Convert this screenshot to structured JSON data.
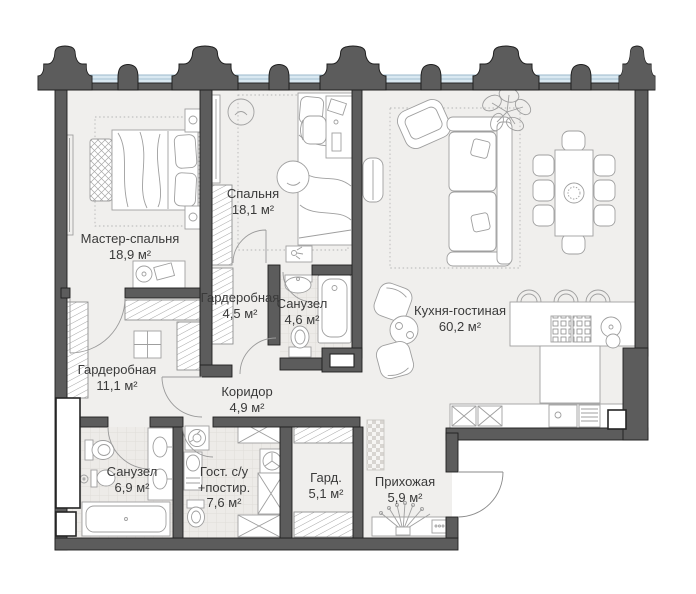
{
  "plan": {
    "type": "apartment-floor-plan",
    "rooms": [
      {
        "name": "Мастер-спальня",
        "area": "18,9 м²"
      },
      {
        "name": "Спальня",
        "area": "18,1 м²"
      },
      {
        "name": "Гардеробная",
        "area": "4,5 м²"
      },
      {
        "name": "Санузел",
        "area": "4,6 м²"
      },
      {
        "name": "Кухня-гостиная",
        "area": "60,2 м²"
      },
      {
        "name": "Гардеробная",
        "area": "11,1 м²"
      },
      {
        "name": "Коридор",
        "area": "4,9 м²"
      },
      {
        "name": "Санузел",
        "area": "6,9 м²"
      },
      {
        "name": "Гост. с/у",
        "name2": "+постир.",
        "area": "7,6 м²"
      },
      {
        "name": "Гард.",
        "area": "5,1 м²"
      },
      {
        "name": "Прихожая",
        "area": "5,9 м²"
      }
    ],
    "colors": {
      "wall": "#5c5c5c",
      "wall_outline": "#1f1f1f",
      "floor": "#f0efed",
      "tile": "#edebe8",
      "glazing": "#d9e8f1",
      "glazing_edge": "#93b3c6",
      "furniture_line": "#9f9f9f",
      "hatch_line": "#8f8f8f",
      "text": "#3a3a3a"
    }
  }
}
